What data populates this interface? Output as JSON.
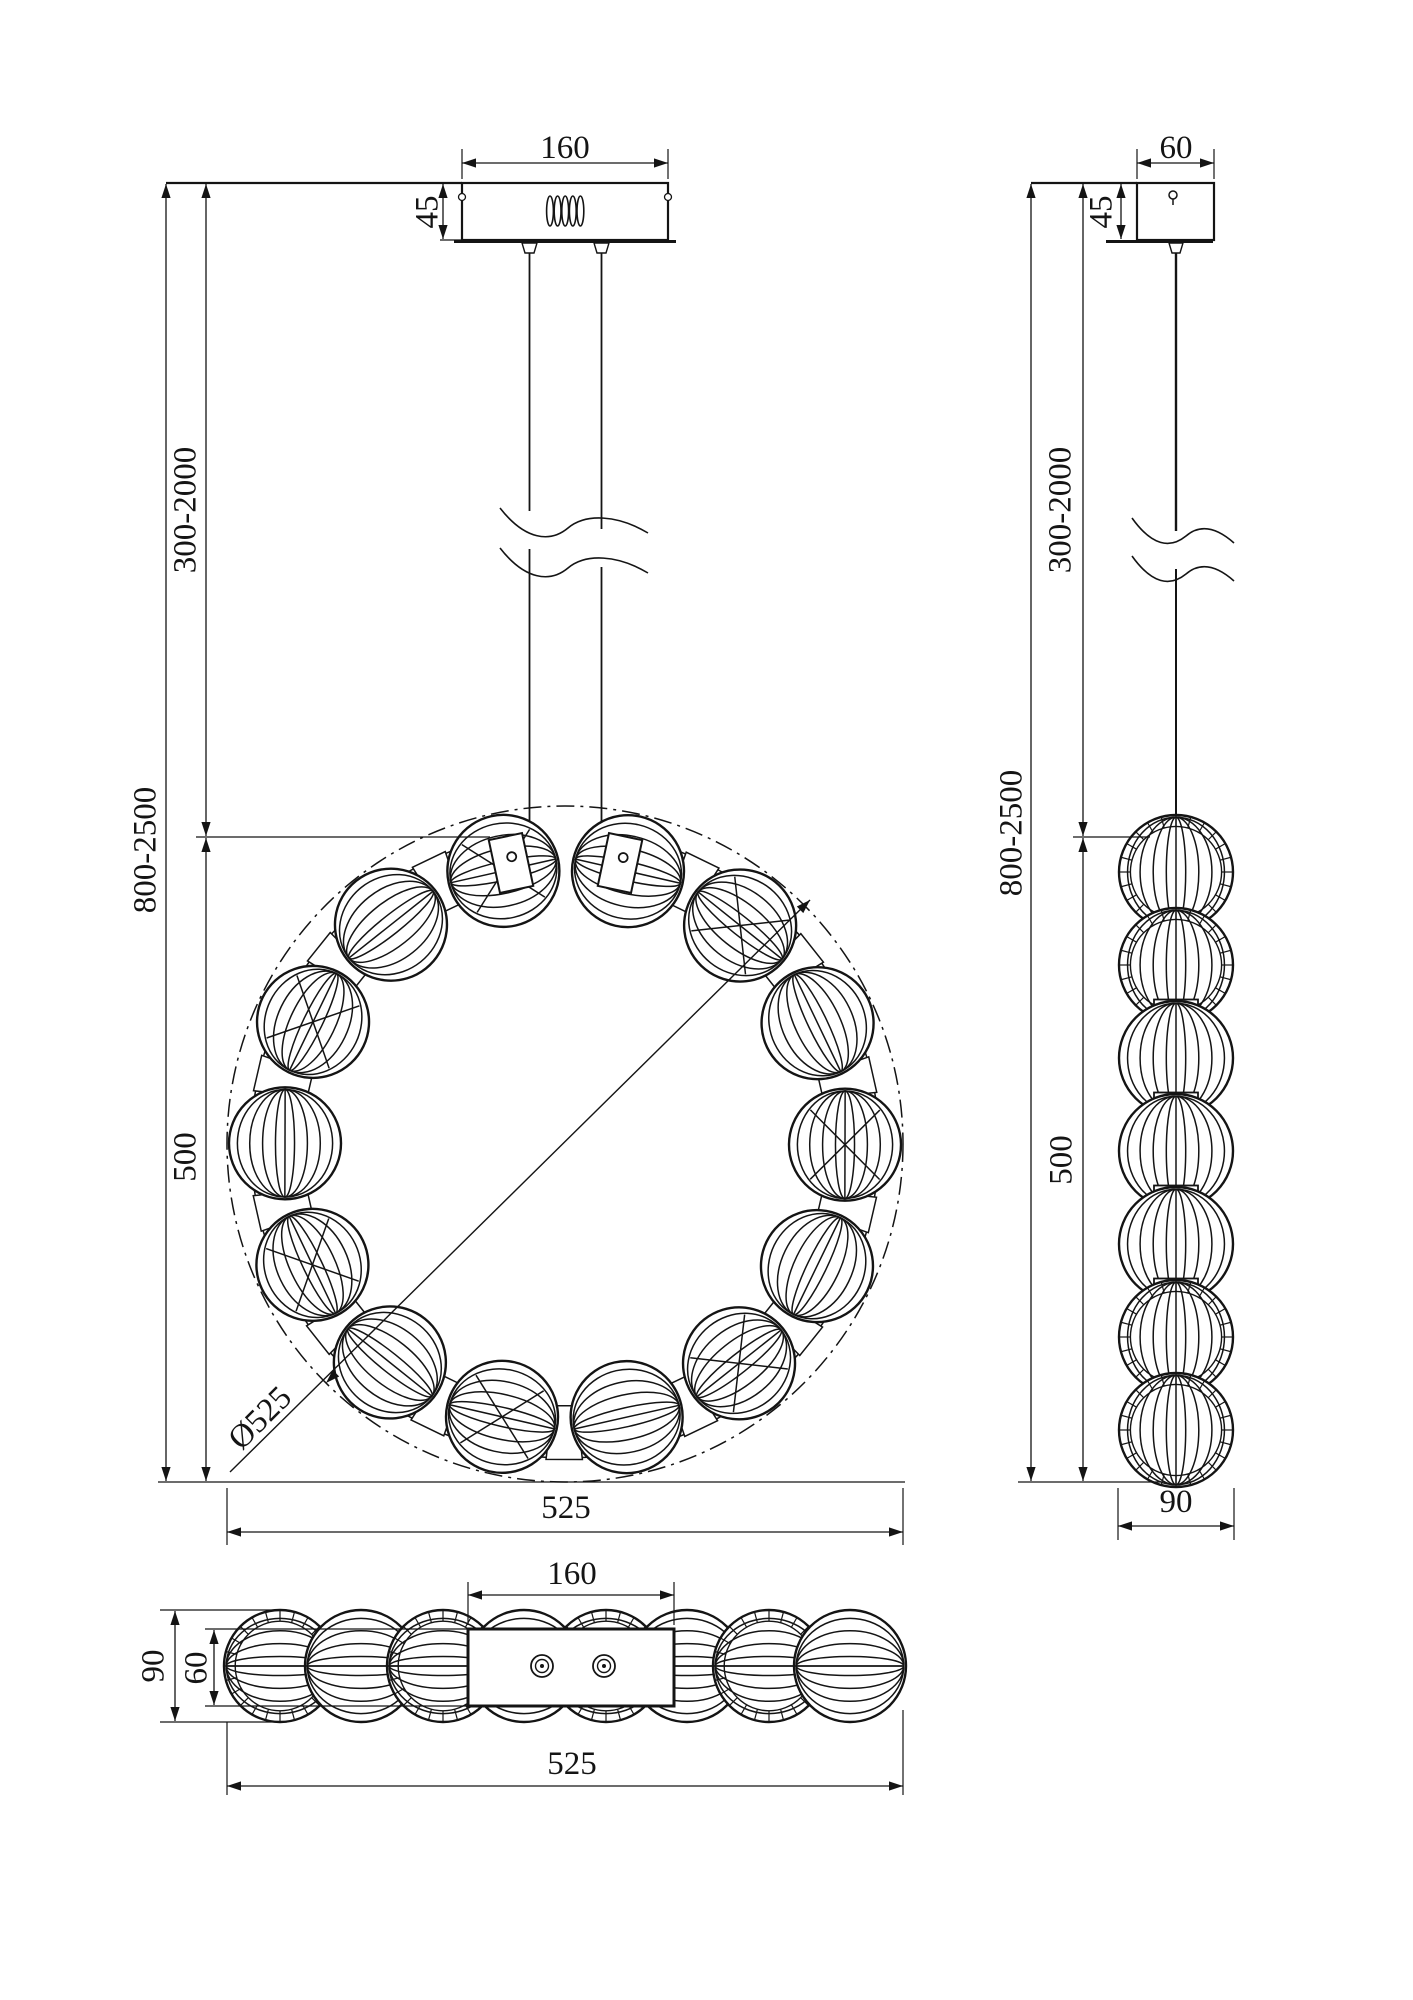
{
  "drawing": {
    "front": {
      "canopy_width": "160",
      "canopy_height": "45",
      "suspension_range": "300-2000",
      "overall_range": "800-2500",
      "body_height": "500",
      "overall_width": "525",
      "ring_diameter": "Ø525"
    },
    "side": {
      "canopy_width": "60",
      "canopy_height": "45",
      "suspension_range": "300-2000",
      "overall_range": "800-2500",
      "body_height": "500",
      "body_width": "90"
    },
    "bottom": {
      "plate_width": "160",
      "body_depth": "90",
      "plate_depth": "60",
      "overall_width": "525"
    },
    "colors": {
      "line": "#141414",
      "background": "#ffffff"
    }
  }
}
